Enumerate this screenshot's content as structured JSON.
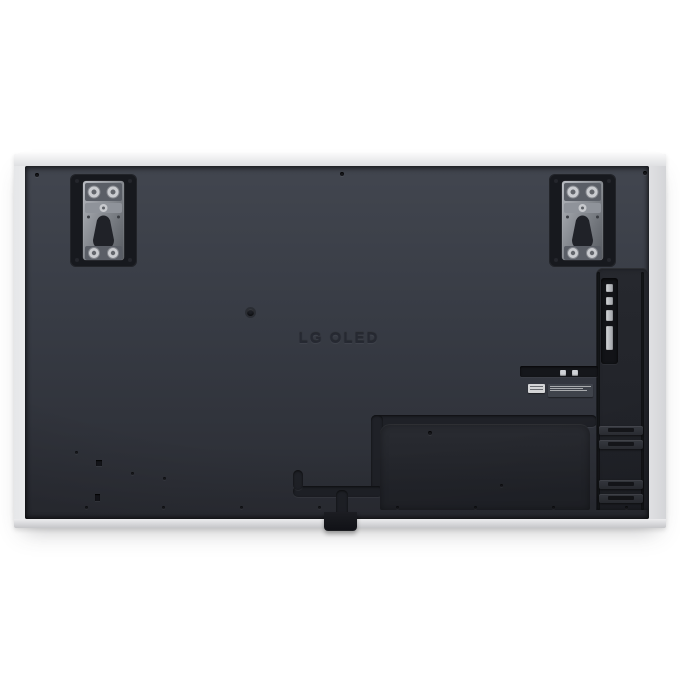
{
  "image": {
    "description": "Rear view product photo of a flat-panel television",
    "logo_text": "LG OLED"
  },
  "theme": {
    "background": "#ffffff",
    "frame_silver": "#f2f3f4",
    "frame_silver_dark": "#c5c6c9",
    "panel_top": "#42464f",
    "panel_mid": "#373b44",
    "panel_bottom": "#2a2c33",
    "channel_color": "#1f2127",
    "cover_dark": "#292b31",
    "logo_color": "#262932",
    "label_light": "#d4d5d7",
    "bracket_metal": "#9aa0a8"
  }
}
